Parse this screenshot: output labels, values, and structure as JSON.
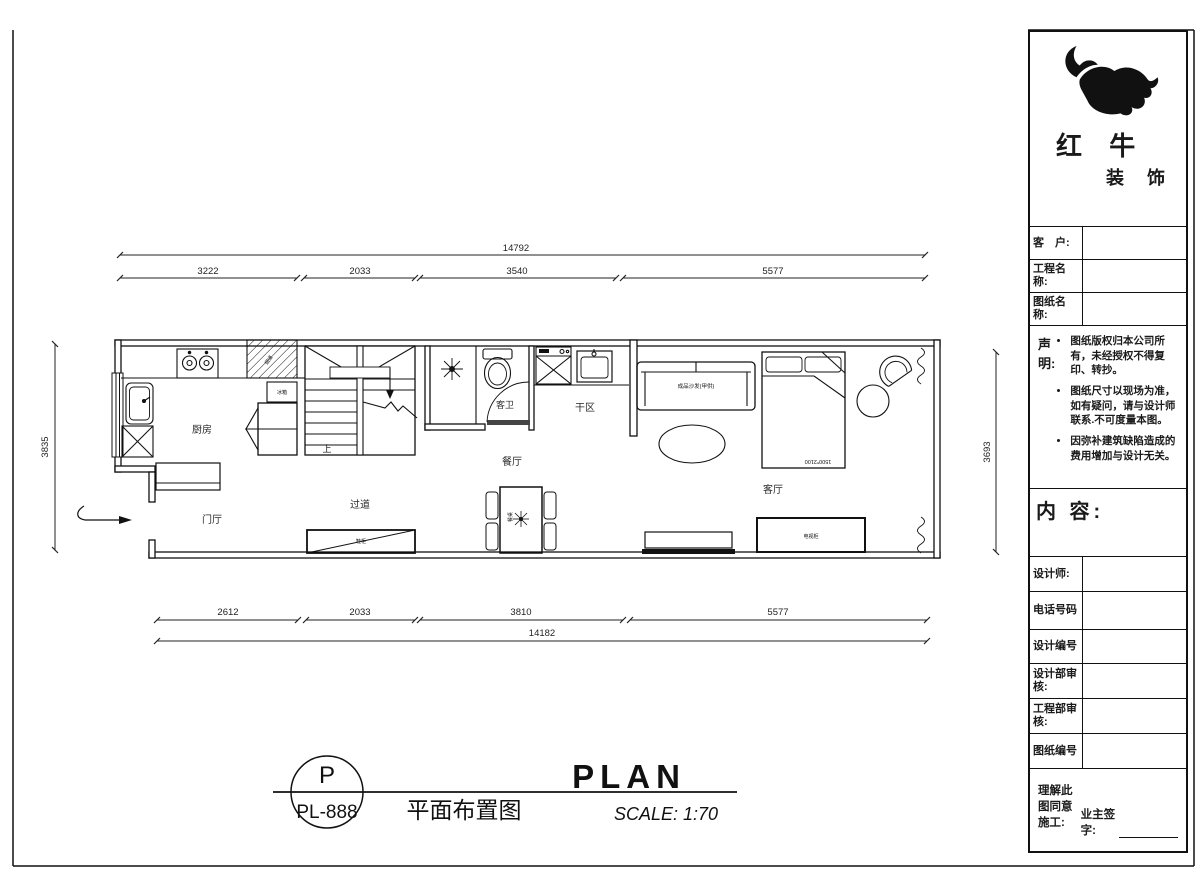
{
  "ink": "#1a1a1a",
  "logo": {
    "name_top": "红 牛",
    "name_bottom": "装 饰"
  },
  "title_block": {
    "customer_label": "客　户:",
    "project_label": "工程名称:",
    "drawing_label": "图纸名称:",
    "statement_title": "声明:",
    "statement_items": [
      "图纸版权归本公司所有，未经授权不得复印、转抄。",
      "图纸尺寸以现场为准，如有疑问，请与设计师联系.不可度量本图。",
      "因弥补建筑缺陷造成的费用增加与设计无关。"
    ],
    "content_label": "内 容:",
    "designer_label": "设计师:",
    "phone_label": "电话号码",
    "design_no_label": "设计编号",
    "design_dept_label": "设计部审核:",
    "engineering_dept_label": "工程部审核:",
    "drawing_no_label": "图纸编号",
    "agree_label": "理解此图同意施工:",
    "owner_sign_label": "业主签字:"
  },
  "rooms": {
    "kitchen": "厨房",
    "foyer": "门厅",
    "corridor": "过道",
    "dining": "餐厅",
    "guest_bath": "客卫",
    "dry_area": "干区",
    "living": "客厅"
  },
  "annotations": {
    "stair_up": "上",
    "sofa": "成品沙发(甲供)",
    "bed_size": "1500*2100",
    "flue": "烟道",
    "fridge": "冰箱",
    "shoe_cabinet": "鞋柜",
    "tv_cabinet": "电视柜",
    "dining_table": "餐桌"
  },
  "dimensions": {
    "top_overall": "14792",
    "top_segments": [
      "3222",
      "2033",
      "3540",
      "5577"
    ],
    "bottom_segments": [
      "2612",
      "2033",
      "3810",
      "5577"
    ],
    "bottom_overall": "14182",
    "left_height": "3835",
    "right_height": "3693"
  },
  "footer": {
    "stamp_letter": "P",
    "stamp_code": "PL-888",
    "title_cn": "平面布置图",
    "title_en": "PLAN",
    "scale": "SCALE: 1:70"
  }
}
